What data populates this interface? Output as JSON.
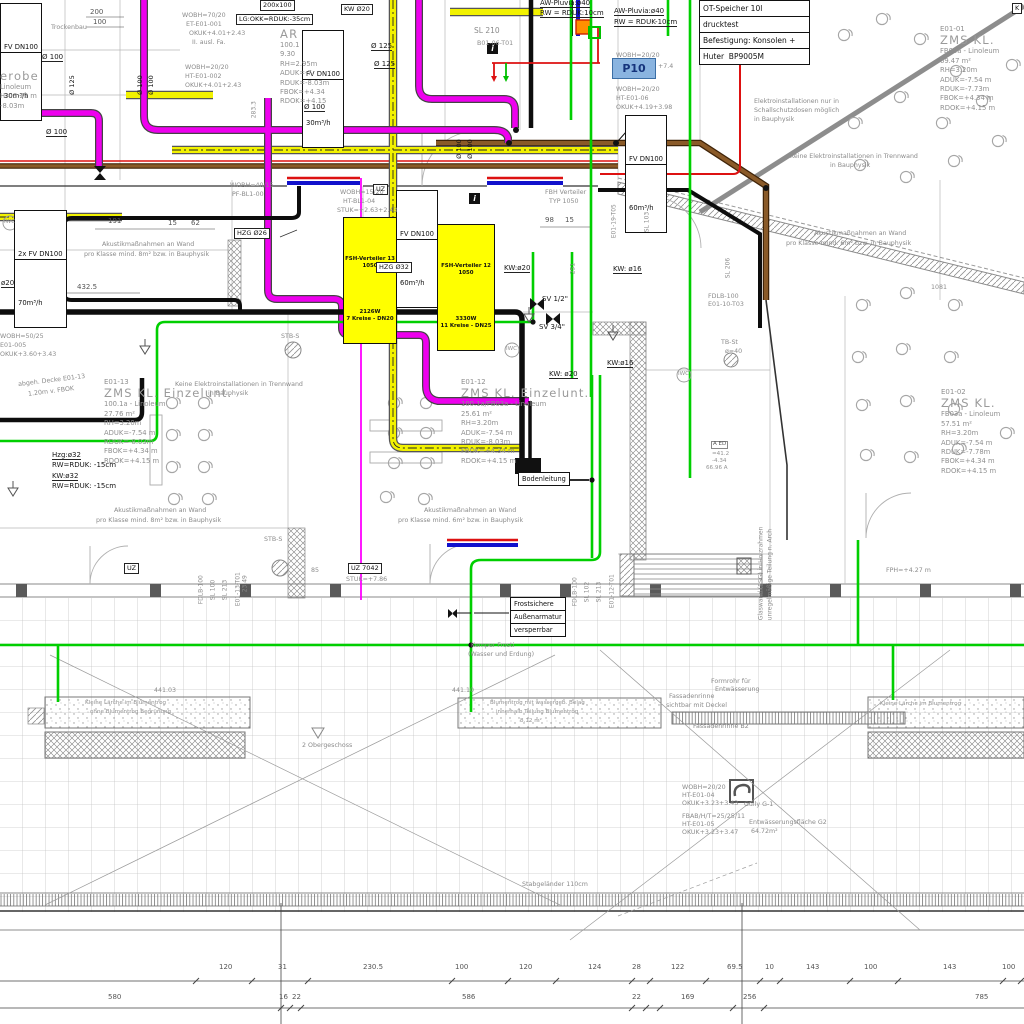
{
  "title_box": {
    "rows": [
      "OT-Speicher 10l",
      "drucktest",
      "Befestigung: Konsolen +",
      "Huter  BP9005M"
    ]
  },
  "p10_label": "P10",
  "info_icon": "i",
  "fv_boxes": [
    {
      "l1": "FV DN100",
      "l2": "30m³/h"
    },
    {
      "l1": "FV DN100",
      "l2": "30m³/h"
    },
    {
      "l1": "2x FV DN100",
      "l2": "70m³/h"
    },
    {
      "l1": "FV DN100",
      "l2": "60m³/h"
    },
    {
      "l1": "FV DN100",
      "l2": "60m³/h"
    }
  ],
  "manifolds": [
    {
      "rows": [
        "FSH-Verteiler 13",
        "1050",
        "2126W",
        "7 Kreise - DN20"
      ]
    },
    {
      "rows": [
        "FSH-Verteiler 12",
        "1050",
        "3330W",
        "11 Kreise - DN25"
      ]
    }
  ],
  "frost_box": {
    "rows": [
      "Frostsichere",
      "Außenarmatur",
      "versperrbar"
    ]
  },
  "boden_box": {
    "label": "Bodenleitung"
  },
  "rooms": [
    {
      "id": "E01-01",
      "name": "ZMS KL.",
      "lines": [
        "FB03a - Linoleum",
        "69.47 m²",
        "RH=3.20m",
        "ADUK=-7.54 m",
        "RDUK=-7.73m",
        "FBOK=+4.34 m",
        "RDOK=+4.15 m"
      ],
      "x": 940,
      "y": 25
    },
    {
      "id": "E01-02",
      "name": "ZMS KL.",
      "lines": [
        "FB03a - Linoleum",
        "57.51 m²",
        "RH=3.20m",
        "ADUK=-7.54 m",
        "RDUK=-7.78m",
        "FBOK=+4.34 m",
        "RDOK=+4.15 m"
      ],
      "x": 941,
      "y": 388
    },
    {
      "id": "E01-12",
      "name": "ZMS KL. Einzelunt.",
      "lines": [
        "100.1a/FB03a - Linoleum",
        "25.61 m²",
        "RH=3.20m",
        "ADUK=-7.54 m",
        "RDUK=-8.03m",
        "FBOK=+4.34 m",
        "RDOK=+4.15 m"
      ],
      "x": 461,
      "y": 378
    },
    {
      "id": "E01-13",
      "name": "ZMS KL. Einzelunt.",
      "lines": [
        "100.1a - Linoleum",
        "27.76 m²",
        "RH=3.20m",
        "ADUK=-7.54 m",
        "RDUK=-8.03m",
        "FBOK=+4.34 m",
        "RDOK=+4.15 m"
      ],
      "x": 104,
      "y": 378
    },
    {
      "id": "",
      "name": "AR",
      "lines": [
        "100.1",
        "9.30",
        "RH=2.95m",
        "ADUK=-7.",
        "RDUK=-8.03m",
        "FBOK=+4.34",
        "RDOK=+4.15"
      ],
      "x": 280,
      "y": 28
    },
    {
      "id": "",
      "name": "erobe",
      "lines": [
        "Linoleum",
        "H= 3.29 m",
        "-8.03m"
      ],
      "x": 0,
      "y": 70
    }
  ],
  "labels": [
    {
      "t": "200",
      "x": 90,
      "y": 9,
      "c": "dim"
    },
    {
      "t": "100",
      "x": 93,
      "y": 19,
      "c": "dim"
    },
    {
      "t": "200x100",
      "x": 260,
      "y": 0,
      "c": "box"
    },
    {
      "t": "LG:OKK=RDUK:-35cm",
      "x": 236,
      "y": 14,
      "c": "box"
    },
    {
      "t": "KW Ø20",
      "x": 341,
      "y": 4,
      "c": "box"
    },
    {
      "t": "K",
      "x": 1012,
      "y": 3,
      "c": "box"
    },
    {
      "t": "AW-Pluvia:ø40",
      "x": 540,
      "y": 0,
      "c": "u"
    },
    {
      "t": "RW = RDUK:10cm",
      "x": 540,
      "y": 10,
      "c": "u"
    },
    {
      "t": "AW-Pluvia:ø40",
      "x": 614,
      "y": 8,
      "c": "u"
    },
    {
      "t": "RW = RDUK-10cm",
      "x": 614,
      "y": 19,
      "c": "u"
    },
    {
      "t": "Ø 125",
      "x": 371,
      "y": 43,
      "c": "u"
    },
    {
      "t": "Ø 125",
      "x": 374,
      "y": 61,
      "c": "u"
    },
    {
      "t": "Ø 100",
      "x": 42,
      "y": 54,
      "c": "u"
    },
    {
      "t": "Ø 100",
      "x": 46,
      "y": 129,
      "c": "u"
    },
    {
      "t": "Ø 100",
      "x": 304,
      "y": 104,
      "c": "u"
    },
    {
      "t": "Ø 100",
      "x": 144,
      "y": 88,
      "c": "r"
    },
    {
      "t": "Ø 100",
      "x": 155,
      "y": 88,
      "c": "r"
    },
    {
      "t": "Ø 125",
      "x": 76,
      "y": 88,
      "c": "r"
    },
    {
      "t": "Ø 100",
      "x": 463,
      "y": 152,
      "c": "r"
    },
    {
      "t": "Ø 100",
      "x": 474,
      "y": 152,
      "c": "r"
    },
    {
      "t": "283.3",
      "x": 258,
      "y": 112,
      "c": "gr"
    },
    {
      "t": "SL 210",
      "x": 474,
      "y": 27,
      "c": "gm"
    },
    {
      "t": "B01-06-T01",
      "x": 477,
      "y": 41,
      "c": "g"
    },
    {
      "t": "WOBH=70/20",
      "x": 182,
      "y": 13,
      "c": "g"
    },
    {
      "t": "ET-E01-001",
      "x": 186,
      "y": 22,
      "c": "g"
    },
    {
      "t": "OKUK+4.01+2.43",
      "x": 189,
      "y": 31,
      "c": "g"
    },
    {
      "t": "II. ausl. Fa.",
      "x": 192,
      "y": 40,
      "c": "g"
    },
    {
      "t": "WOBH=20/20",
      "x": 185,
      "y": 65,
      "c": "g"
    },
    {
      "t": "HT-E01-002",
      "x": 185,
      "y": 74,
      "c": "g"
    },
    {
      "t": "OKUK+4.01+2.43",
      "x": 185,
      "y": 83,
      "c": "g"
    },
    {
      "t": "Trockenbau",
      "x": 51,
      "y": 25,
      "c": "g"
    },
    {
      "t": "WOBH=20/20",
      "x": 616,
      "y": 53,
      "c": "g"
    },
    {
      "t": "WOBH=20/20",
      "x": 616,
      "y": 87,
      "c": "g"
    },
    {
      "t": "HT-E01-06",
      "x": 616,
      "y": 96,
      "c": "g"
    },
    {
      "t": "OKUK+4.19+3.98",
      "x": 616,
      "y": 105,
      "c": "g"
    },
    {
      "t": "Elektroinstallationen nur in",
      "x": 754,
      "y": 99,
      "c": "g"
    },
    {
      "t": "Schallschutzdosen möglich",
      "x": 754,
      "y": 108,
      "c": "g"
    },
    {
      "t": "in Bauphysik",
      "x": 754,
      "y": 117,
      "c": "g"
    },
    {
      "t": "Keine Elektroinstallationen in Trennwand",
      "x": 790,
      "y": 154,
      "c": "g"
    },
    {
      "t": "in Bauphysik",
      "x": 830,
      "y": 163,
      "c": "g"
    },
    {
      "t": "+7.4",
      "x": 658,
      "y": 64,
      "c": "g"
    },
    {
      "t": "HZG Ø26",
      "x": 234,
      "y": 228,
      "c": "box"
    },
    {
      "t": "HZG Ø32",
      "x": 376,
      "y": 262,
      "c": "box"
    },
    {
      "t": "UZ",
      "x": 373,
      "y": 184,
      "c": "box"
    },
    {
      "t": "UZ",
      "x": 124,
      "y": 563,
      "c": "box"
    },
    {
      "t": "UZ 7042",
      "x": 348,
      "y": 563,
      "c": "box"
    },
    {
      "t": "STUK=+7.86",
      "x": 346,
      "y": 577,
      "c": "g"
    },
    {
      "t": "WOBH=15/20",
      "x": 340,
      "y": 190,
      "c": "g"
    },
    {
      "t": "HT-BL1-04",
      "x": 343,
      "y": 199,
      "c": "g"
    },
    {
      "t": "STUK=+2.63+2.43",
      "x": 337,
      "y": 208,
      "c": "g"
    },
    {
      "t": "WOBH=40/15",
      "x": 230,
      "y": 183,
      "c": "g"
    },
    {
      "t": "PF-BL1-00",
      "x": 232,
      "y": 192,
      "c": "g"
    },
    {
      "t": "FBH Verteiler",
      "x": 545,
      "y": 190,
      "c": "g"
    },
    {
      "t": "TYP 1050",
      "x": 549,
      "y": 199,
      "c": "g"
    },
    {
      "t": "98",
      "x": 545,
      "y": 217,
      "c": "dim"
    },
    {
      "t": "15",
      "x": 565,
      "y": 217,
      "c": "dim"
    },
    {
      "t": "191",
      "x": 108,
      "y": 218,
      "c": "dim"
    },
    {
      "t": "15",
      "x": 168,
      "y": 220,
      "c": "dim"
    },
    {
      "t": "62",
      "x": 191,
      "y": 220,
      "c": "dim"
    },
    {
      "t": "432.5",
      "x": 77,
      "y": 284,
      "c": "dim"
    },
    {
      "t": "251",
      "x": 577,
      "y": 268,
      "c": "gr"
    },
    {
      "t": "Akustikmaßnahmen an Wand",
      "x": 102,
      "y": 242,
      "c": "g"
    },
    {
      "t": "pro Klasse mind. 8m² bzw. in Bauphysik",
      "x": 84,
      "y": 252,
      "c": "g"
    },
    {
      "t": "Akustikmaßnahmen an Wand",
      "x": 814,
      "y": 231,
      "c": "g"
    },
    {
      "t": "pro Klasse mind. 6m² bzw. in Bauphysik",
      "x": 786,
      "y": 241,
      "c": "g"
    },
    {
      "t": "KW:ø20",
      "x": 504,
      "y": 265,
      "c": "u"
    },
    {
      "t": "KW: ø16",
      "x": 613,
      "y": 266,
      "c": "u"
    },
    {
      "t": "ø20",
      "x": 1,
      "y": 280,
      "c": "u"
    },
    {
      "t": "SV 1/2\"",
      "x": 542,
      "y": 296,
      "c": "d"
    },
    {
      "t": "SV 3/4\"",
      "x": 539,
      "y": 324,
      "c": "d"
    },
    {
      "t": "KW:ø16",
      "x": 607,
      "y": 360,
      "c": "u"
    },
    {
      "t": "KW: ø20",
      "x": 549,
      "y": 371,
      "c": "u"
    },
    {
      "t": "1081",
      "x": 931,
      "y": 285,
      "c": "g"
    },
    {
      "t": "E01-19-T05",
      "x": 618,
      "y": 232,
      "c": "gr"
    },
    {
      "t": "SL 103",
      "x": 651,
      "y": 226,
      "c": "gr"
    },
    {
      "t": "SL 206",
      "x": 732,
      "y": 272,
      "c": "gr"
    },
    {
      "t": "FDLB-100",
      "x": 708,
      "y": 294,
      "c": "g"
    },
    {
      "t": "E01-10-T03",
      "x": 708,
      "y": 302,
      "c": "g"
    },
    {
      "t": "TB-St",
      "x": 721,
      "y": 340,
      "c": "g"
    },
    {
      "t": "ø=40",
      "x": 725,
      "y": 349,
      "c": "g"
    },
    {
      "t": "STB-S",
      "x": 281,
      "y": 334,
      "c": "g"
    },
    {
      "t": "STB-S",
      "x": 264,
      "y": 537,
      "c": "g"
    },
    {
      "t": "IWC",
      "x": 4,
      "y": 220,
      "c": "gs"
    },
    {
      "t": "IWC",
      "x": 506,
      "y": 347,
      "c": "gs"
    },
    {
      "t": "IWC",
      "x": 678,
      "y": 372,
      "c": "gs"
    },
    {
      "t": "abgeh. Decke E01-13",
      "x": 18,
      "y": 378,
      "c": "gt"
    },
    {
      "t": "1.20m v. FBOK",
      "x": 28,
      "y": 389,
      "c": "gt"
    },
    {
      "t": "Keine Elektroinstallationen in Trennwand",
      "x": 175,
      "y": 382,
      "c": "g"
    },
    {
      "t": "in Bauphysik",
      "x": 208,
      "y": 391,
      "c": "g"
    },
    {
      "t": "Hzg:ø32",
      "x": 52,
      "y": 452,
      "c": "u"
    },
    {
      "t": "RW=RDUK: -15cm",
      "x": 52,
      "y": 462,
      "c": "d"
    },
    {
      "t": "KW:ø32",
      "x": 52,
      "y": 473,
      "c": "u"
    },
    {
      "t": "RW=RDUK: -15cm",
      "x": 52,
      "y": 483,
      "c": "d"
    },
    {
      "t": "Akustikmaßnahmen an Wand",
      "x": 114,
      "y": 508,
      "c": "g"
    },
    {
      "t": "pro Klasse mind. 8m² bzw. in Bauphysik",
      "x": 96,
      "y": 518,
      "c": "g"
    },
    {
      "t": "Akustikmaßnahmen an Wand",
      "x": 424,
      "y": 508,
      "c": "g"
    },
    {
      "t": "pro Klasse mind. 6m² bzw. in Bauphysik",
      "x": 398,
      "y": 518,
      "c": "g"
    },
    {
      "t": "A ED",
      "x": 711,
      "y": 441,
      "c": "box2"
    },
    {
      "t": "=41.2",
      "x": 712,
      "y": 452,
      "c": "gs"
    },
    {
      "t": "-4.34",
      "x": 712,
      "y": 459,
      "c": "gs"
    },
    {
      "t": "66.96 A",
      "x": 706,
      "y": 466,
      "c": "gs"
    },
    {
      "t": "23.49",
      "x": 249,
      "y": 586,
      "c": "gr"
    },
    {
      "t": "85",
      "x": 311,
      "y": 568,
      "c": "g"
    },
    {
      "t": "FDLB-100",
      "x": 205,
      "y": 598,
      "c": "gr"
    },
    {
      "t": "SL 100",
      "x": 217,
      "y": 594,
      "c": "gr"
    },
    {
      "t": "SL 213",
      "x": 229,
      "y": 594,
      "c": "gr"
    },
    {
      "t": "E01-13-T01",
      "x": 242,
      "y": 600,
      "c": "gr"
    },
    {
      "t": "FDLB-100",
      "x": 579,
      "y": 600,
      "c": "gr"
    },
    {
      "t": "SL 102",
      "x": 591,
      "y": 596,
      "c": "gr"
    },
    {
      "t": "SL 213",
      "x": 603,
      "y": 596,
      "c": "gr"
    },
    {
      "t": "E01-12-T01",
      "x": 616,
      "y": 602,
      "c": "gr"
    },
    {
      "t": "Glaswand (ESG) in Holzrahmen",
      "x": 765,
      "y": 614,
      "c": "gr"
    },
    {
      "t": "unregelmäßige Teilung n. Arch",
      "x": 774,
      "y": 614,
      "c": "gr"
    },
    {
      "t": "FPH=+4.27 m",
      "x": 886,
      "y": 568,
      "c": "g"
    },
    {
      "t": "WOBH=50/25",
      "x": 0,
      "y": 334,
      "c": "g"
    },
    {
      "t": "E01-005",
      "x": 0,
      "y": 343,
      "c": "g"
    },
    {
      "t": "OKUK+3.60+3.43",
      "x": 0,
      "y": 352,
      "c": "g"
    },
    {
      "t": "441.03",
      "x": 154,
      "y": 688,
      "c": "g"
    },
    {
      "t": "441.10",
      "x": 452,
      "y": 688,
      "c": "g"
    },
    {
      "t": "Kemper Frosti",
      "x": 471,
      "y": 643,
      "c": "g"
    },
    {
      "t": "(Wasser und Erdung)",
      "x": 468,
      "y": 652,
      "c": "g"
    },
    {
      "t": "Kleine Lärche im Blumentrog",
      "x": 85,
      "y": 701,
      "c": "gs"
    },
    {
      "t": "ohne Blumentrog Begrünung",
      "x": 90,
      "y": 710,
      "c": "gs"
    },
    {
      "t": "Blumentrog mit wassergeb. Belag",
      "x": 490,
      "y": 701,
      "c": "gs"
    },
    {
      "t": "innerhalb Teilung Blumentrog",
      "x": 496,
      "y": 710,
      "c": "gs"
    },
    {
      "t": "8.12 m²",
      "x": 520,
      "y": 719,
      "c": "gs"
    },
    {
      "t": "Kleine Lärche im Blumentrog",
      "x": 880,
      "y": 702,
      "c": "gs"
    },
    {
      "t": "Formrohr für",
      "x": 711,
      "y": 679,
      "c": "g"
    },
    {
      "t": "Entwässerung",
      "x": 715,
      "y": 687,
      "c": "g"
    },
    {
      "t": "Fassadenrinne",
      "x": 669,
      "y": 694,
      "c": "g"
    },
    {
      "t": "sichtbar mit Deckel",
      "x": 666,
      "y": 703,
      "c": "g"
    },
    {
      "t": "Fassadenrinne B2",
      "x": 693,
      "y": 724,
      "c": "g"
    },
    {
      "t": "2 Obergeschoss",
      "x": 302,
      "y": 743,
      "c": "g"
    },
    {
      "t": "WOBH=20/20",
      "x": 682,
      "y": 785,
      "c": "g"
    },
    {
      "t": "HT-E01-04",
      "x": 682,
      "y": 793,
      "c": "g"
    },
    {
      "t": "OKUK+3.23+3.43",
      "x": 682,
      "y": 801,
      "c": "g"
    },
    {
      "t": "Gully G-1",
      "x": 744,
      "y": 802,
      "c": "g"
    },
    {
      "t": "FBAB/H/T=25/25/11",
      "x": 682,
      "y": 814,
      "c": "g"
    },
    {
      "t": "HT-E01-05",
      "x": 682,
      "y": 822,
      "c": "g"
    },
    {
      "t": "OKUK+3.23+3.47",
      "x": 682,
      "y": 830,
      "c": "g"
    },
    {
      "t": "Entwässerungsfläche G2",
      "x": 749,
      "y": 820,
      "c": "g"
    },
    {
      "t": "64.72m²",
      "x": 751,
      "y": 829,
      "c": "g"
    },
    {
      "t": "Stabgeländer 110cm",
      "x": 522,
      "y": 882,
      "c": "g"
    },
    {
      "t": "120",
      "x": 219,
      "y": 964,
      "c": "dim"
    },
    {
      "t": "31",
      "x": 278,
      "y": 964,
      "c": "dim"
    },
    {
      "t": "230.5",
      "x": 363,
      "y": 964,
      "c": "dim"
    },
    {
      "t": "100",
      "x": 455,
      "y": 964,
      "c": "dim"
    },
    {
      "t": "120",
      "x": 519,
      "y": 964,
      "c": "dim"
    },
    {
      "t": "124",
      "x": 588,
      "y": 964,
      "c": "dim"
    },
    {
      "t": "28",
      "x": 632,
      "y": 964,
      "c": "dim"
    },
    {
      "t": "122",
      "x": 671,
      "y": 964,
      "c": "dim"
    },
    {
      "t": "69.5",
      "x": 727,
      "y": 964,
      "c": "dim"
    },
    {
      "t": "10",
      "x": 765,
      "y": 964,
      "c": "dim"
    },
    {
      "t": "143",
      "x": 806,
      "y": 964,
      "c": "dim"
    },
    {
      "t": "100",
      "x": 864,
      "y": 964,
      "c": "dim"
    },
    {
      "t": "143",
      "x": 943,
      "y": 964,
      "c": "dim"
    },
    {
      "t": "100",
      "x": 1002,
      "y": 964,
      "c": "dim"
    },
    {
      "t": "580",
      "x": 108,
      "y": 994,
      "c": "dim"
    },
    {
      "t": "16",
      "x": 279,
      "y": 994,
      "c": "dim"
    },
    {
      "t": "22",
      "x": 292,
      "y": 994,
      "c": "dim"
    },
    {
      "t": "586",
      "x": 462,
      "y": 994,
      "c": "dim"
    },
    {
      "t": "22",
      "x": 632,
      "y": 994,
      "c": "dim"
    },
    {
      "t": "169",
      "x": 681,
      "y": 994,
      "c": "dim"
    },
    {
      "t": "256",
      "x": 743,
      "y": 994,
      "c": "dim"
    },
    {
      "t": "785",
      "x": 975,
      "y": 994,
      "c": "dim"
    }
  ],
  "colors": {
    "pipe_yellow": "#f2f200",
    "pipe_magenta": "#ee00ee",
    "pipe_green": "#00cf00",
    "pipe_brown": "#8a5a28",
    "pipe_red": "#dd1111",
    "pipe_blue": "#1111cc",
    "marker_blue_fill": "#8ab4e0",
    "manifold_yellow": "#ffff00"
  }
}
